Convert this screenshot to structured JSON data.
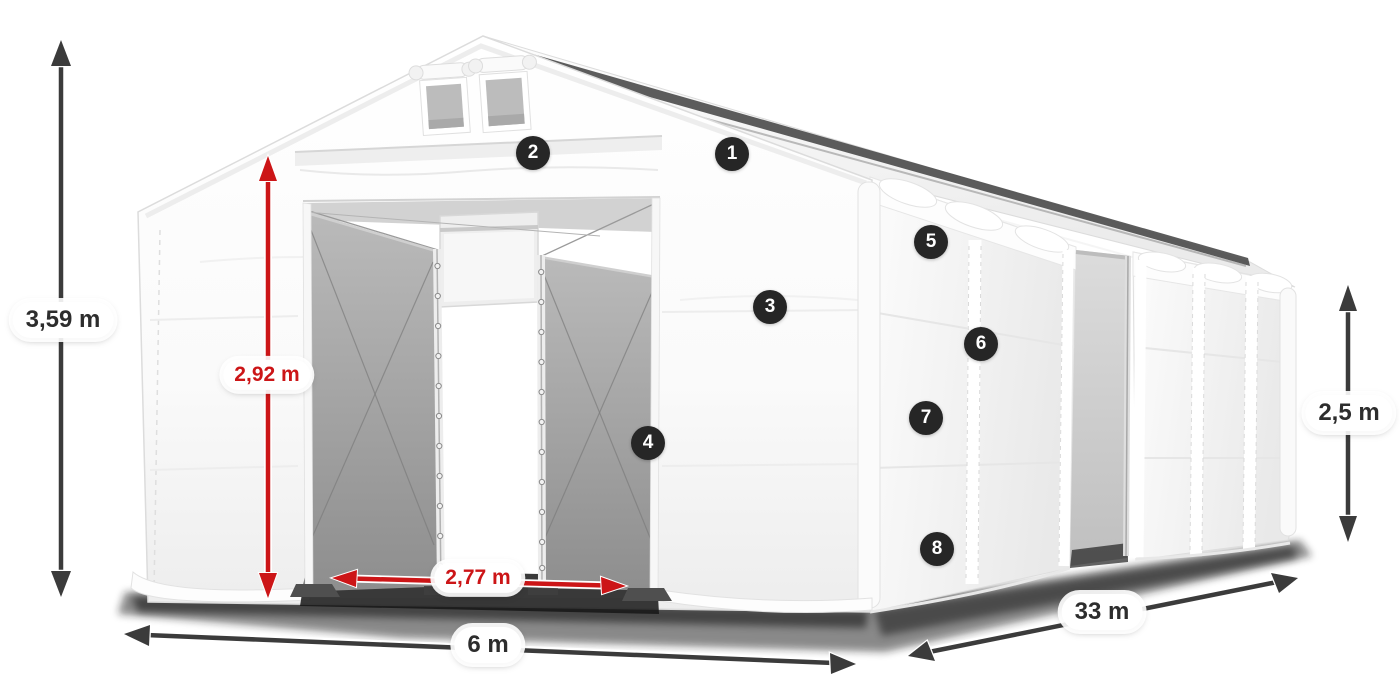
{
  "dimensions": {
    "total_height": "3,59 m",
    "entrance_height": "2,92 m",
    "entrance_width": "2,77 m",
    "front_width": "6 m",
    "side_length": "33 m",
    "side_height": "2,5 m"
  },
  "markers": [
    {
      "label": "1"
    },
    {
      "label": "2"
    },
    {
      "label": "3"
    },
    {
      "label": "4"
    },
    {
      "label": "5"
    },
    {
      "label": "6"
    },
    {
      "label": "7"
    },
    {
      "label": "8"
    }
  ],
  "colors": {
    "background": "#ffffff",
    "dimension_arrow_dark": "#3b3b3b",
    "dimension_arrow_red": "#cc1517",
    "dimension_text_dark": "#2d2d2d",
    "dimension_text_red": "#cc1517",
    "marker_background": "#262626",
    "marker_text": "#ffffff",
    "tent_fabric": "#ffffff",
    "door_panel_gray": "#a5a5a5"
  }
}
